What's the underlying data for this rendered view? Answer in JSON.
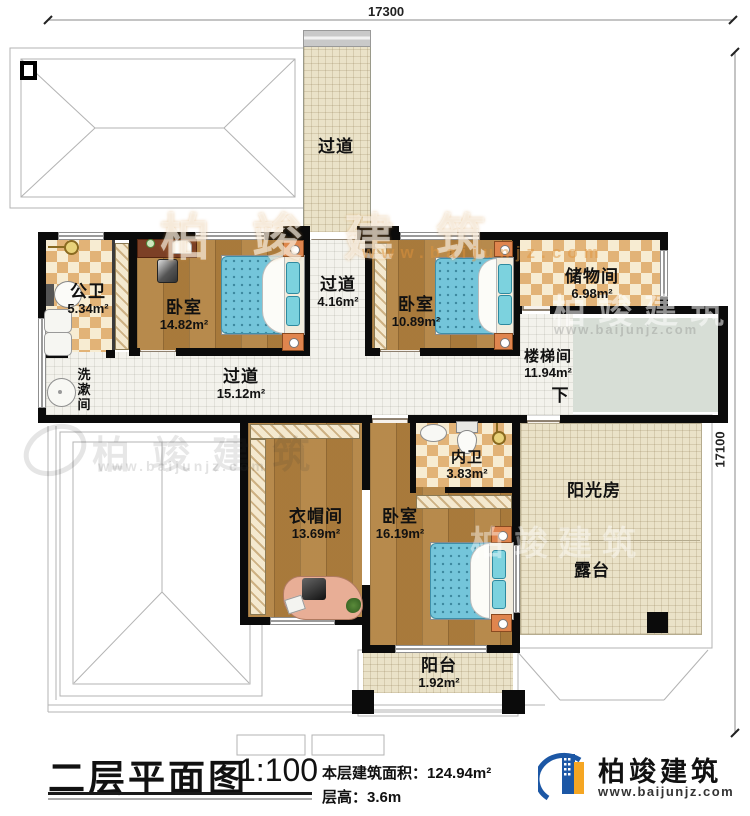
{
  "dimensions": {
    "top": "17300",
    "right": "17100"
  },
  "rooms": {
    "corridor_top": {
      "name": "过道"
    },
    "public_bath": {
      "name": "公卫",
      "area": "5.34m²"
    },
    "bedroom1": {
      "name": "卧室",
      "area": "14.82m²"
    },
    "corridor_mid": {
      "name": "过道",
      "area": "4.16m²"
    },
    "bedroom2": {
      "name": "卧室",
      "area": "10.89m²"
    },
    "storage": {
      "name": "储物间",
      "area": "6.98m²"
    },
    "stairwell": {
      "name": "楼梯间",
      "area": "11.94m²",
      "down_label": "下"
    },
    "washroom": {
      "name": "洗漱间"
    },
    "corridor_main": {
      "name": "过道",
      "area": "15.12m²"
    },
    "cloakroom": {
      "name": "衣帽间",
      "area": "13.69m²"
    },
    "inner_bath": {
      "name": "内卫",
      "area": "3.83m²"
    },
    "bedroom3": {
      "name": "卧室",
      "area": "16.19m²"
    },
    "sunroom": {
      "name": "阳光房"
    },
    "terrace": {
      "name": "露台"
    },
    "balcony": {
      "name": "阳台",
      "area": "1.92m²"
    }
  },
  "title_block": {
    "title": "二层平面图",
    "scale": "1:100",
    "area_label": "本层建筑面积：",
    "area_value": "124.94m²",
    "height_label": "层高：",
    "height_value": "3.6m"
  },
  "logo": {
    "name": "柏竣建筑",
    "url": "www.baijunjz.com"
  },
  "watermark": {
    "brand": "柏竣建筑",
    "url": "www.baijunjz.com"
  }
}
